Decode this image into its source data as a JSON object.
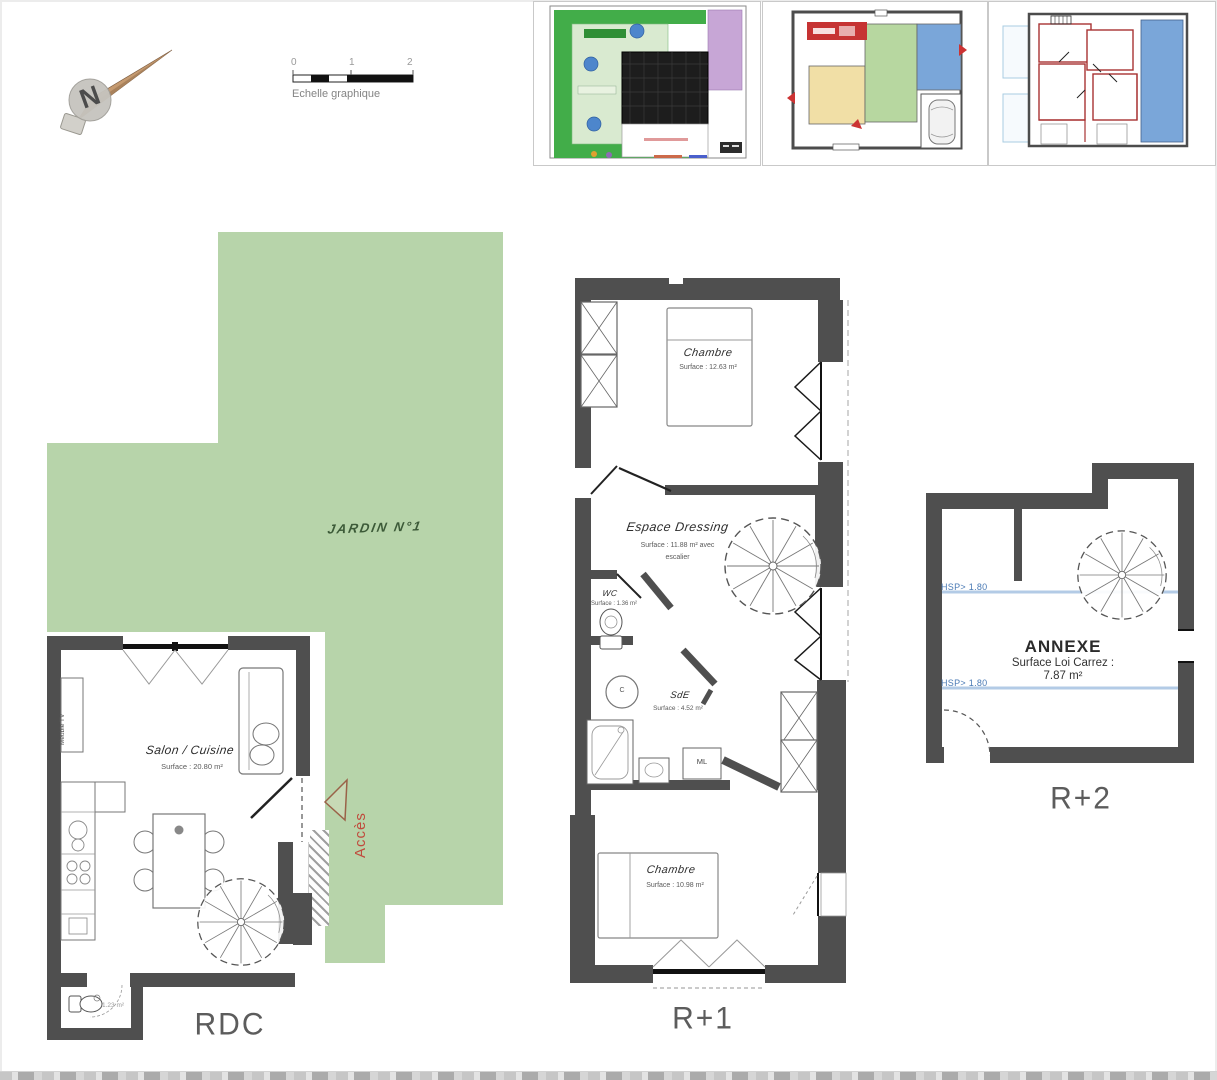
{
  "compass": {
    "letter": "N"
  },
  "scale_bar": {
    "ticks": [
      "0",
      "1",
      "2"
    ],
    "label": "Echelle graphique"
  },
  "garden": {
    "label": "JARDIN N°1"
  },
  "access": {
    "label": "Accès"
  },
  "rdc": {
    "floor_label": "RDC",
    "salon": {
      "name": "Salon / Cuisine",
      "surface": "Surface : 20.80 m²"
    },
    "meuble_tv": "Meuble TV",
    "wc_surface": "1.23 m²"
  },
  "r1": {
    "floor_label": "R+1",
    "chambre_top": {
      "name": "Chambre",
      "surface": "Surface : 12.63 m²"
    },
    "dressing": {
      "name": "Espace Dressing",
      "surface_line1": "Surface : 11.88 m² avec",
      "surface_line2": "escalier"
    },
    "wc": {
      "name": "WC",
      "surface": "Surface : 1.36 m²"
    },
    "sde": {
      "name": "SdE",
      "surface": "Surface : 4.52 m²"
    },
    "chambre_bottom": {
      "name": "Chambre",
      "surface": "Surface : 10.98 m²"
    },
    "labels": {
      "c": "C",
      "ml": "ML"
    }
  },
  "r2": {
    "floor_label": "R+2",
    "annexe": {
      "name": "ANNEXE",
      "carrez_label": "Surface Loi Carrez :",
      "carrez_value": "7.87 m²"
    },
    "hsp_top": "HSP> 1.80",
    "hsp_bottom": "HSP> 1.80"
  },
  "colors": {
    "wall": "#4f4f4f",
    "garden_green": "#b7d4aa",
    "access_red": "#c04b3d",
    "hsp_blue": "#4a7ab5"
  }
}
